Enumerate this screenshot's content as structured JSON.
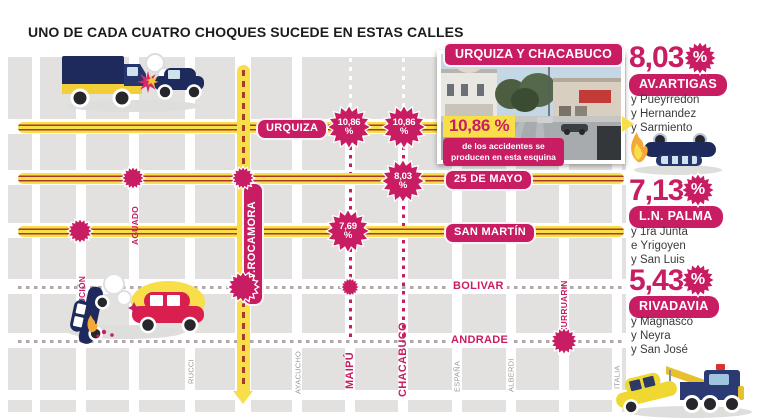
{
  "title": "UNO DE CADA CUATRO CHOQUES SUCEDE EN ESTAS CALLES",
  "colors": {
    "pink": "#c81d63",
    "yellow": "#f8df4a",
    "street_red": "#a83a2a",
    "block_gray": "#e2e1e0"
  },
  "map": {
    "streets_horizontal": [
      {
        "label": "URQUIZA"
      },
      {
        "label": "25 DE MAYO"
      },
      {
        "label": "SAN MARTÍN"
      },
      {
        "label": "BOLIVAR"
      },
      {
        "label": "ANDRADE"
      }
    ],
    "streets_vertical": [
      {
        "label": "CONSTITUCIÓN"
      },
      {
        "label": "AGUADO"
      },
      {
        "label": "RUCCI"
      },
      {
        "label": "AV.ROCAMORA"
      },
      {
        "label": "AYACUCHO"
      },
      {
        "label": "MAIPÚ"
      },
      {
        "label": "CHACABUCO"
      },
      {
        "label": "ESPAÑA"
      },
      {
        "label": "ALBERDI"
      },
      {
        "label": "CHURRUARIN"
      },
      {
        "label": "ITALIA"
      }
    ],
    "badges": [
      {
        "value": "10,86",
        "unit": "%",
        "at": "Urquiza y Maipú"
      },
      {
        "value": "10,86",
        "unit": "%",
        "at": "Urquiza y Chacabuco"
      },
      {
        "value": "8,03",
        "unit": "%",
        "at": "25 de Mayo y Chacabuco"
      },
      {
        "value": "7,69",
        "unit": "%",
        "at": "San Martín y Maipú"
      }
    ]
  },
  "inset": {
    "title": "URQUIZA Y CHACABUCO",
    "stat": "10,86 %",
    "caption": [
      "de los accidentes se",
      "producen en esta esquina"
    ]
  },
  "stats": [
    {
      "value": "8,03",
      "unit": "%",
      "street": "AV.ARTIGAS",
      "cross": [
        "y Pueyrredon",
        "y Hernandez",
        "y Sarmiento"
      ]
    },
    {
      "value": "7,13",
      "unit": "%",
      "street": "L.N. PALMA",
      "cross": [
        "y 1ra Junta",
        "e Yrigoyen",
        "y San Luis"
      ]
    },
    {
      "value": "5,43",
      "unit": "%",
      "street": "RIVADAVIA",
      "cross": [
        "y Magnasco",
        "y Neyra",
        "y San José"
      ]
    }
  ]
}
